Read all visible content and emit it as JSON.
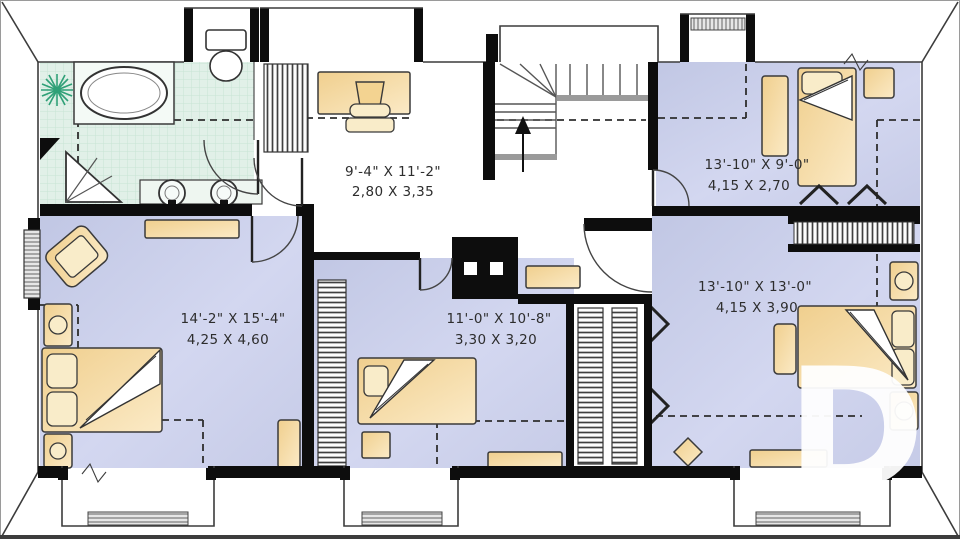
{
  "watermark": {
    "letter": "D"
  },
  "rooms": [
    {
      "name": "office",
      "imperial": "9'-4\" X 11'-2\"",
      "metric": "2,80 X 3,35"
    },
    {
      "name": "bedroom-top-right",
      "imperial": "13'-10\" X 9'-0\"",
      "metric": "4,15 X 2,70"
    },
    {
      "name": "bedroom-right",
      "imperial": "13'-10\" X 13'-0\"",
      "metric": "4,15 X 3,90"
    },
    {
      "name": "master-bedroom",
      "imperial": "14'-2\" X 15'-4\"",
      "metric": "4,25 X 4,60"
    },
    {
      "name": "bedroom-center",
      "imperial": "11'-0\" X 10'-8\"",
      "metric": "3,30 X 3,20"
    }
  ],
  "colors": {
    "floor": "#cdd2ec",
    "bathroom_floor": "#e1f0e8",
    "furniture": "#f6dca4",
    "wall": "#0d0d0d",
    "line": "#3c3c3c",
    "plant": "#2fa077",
    "watermark": "#ffffff"
  },
  "fixtures": {
    "bathroom": [
      "bathtub",
      "toilet",
      "corner-shower",
      "double-sink-vanity",
      "plant"
    ],
    "office": [
      "desk",
      "chair",
      "wardrobe-closet"
    ],
    "hall": [
      "staircase-up",
      "chimney",
      "shelf"
    ],
    "bedroom_top_right": [
      "bed",
      "dresser",
      "nightstand"
    ],
    "bedroom_right": [
      "bed",
      "bench",
      "nightstand",
      "nightstand",
      "stool",
      "dresser",
      "double-closet"
    ],
    "master_bedroom": [
      "bed",
      "nightstand",
      "nightstand",
      "armchair",
      "dresser",
      "dresser"
    ],
    "bedroom_center": [
      "bed",
      "nightstand",
      "dresser",
      "closet"
    ]
  }
}
